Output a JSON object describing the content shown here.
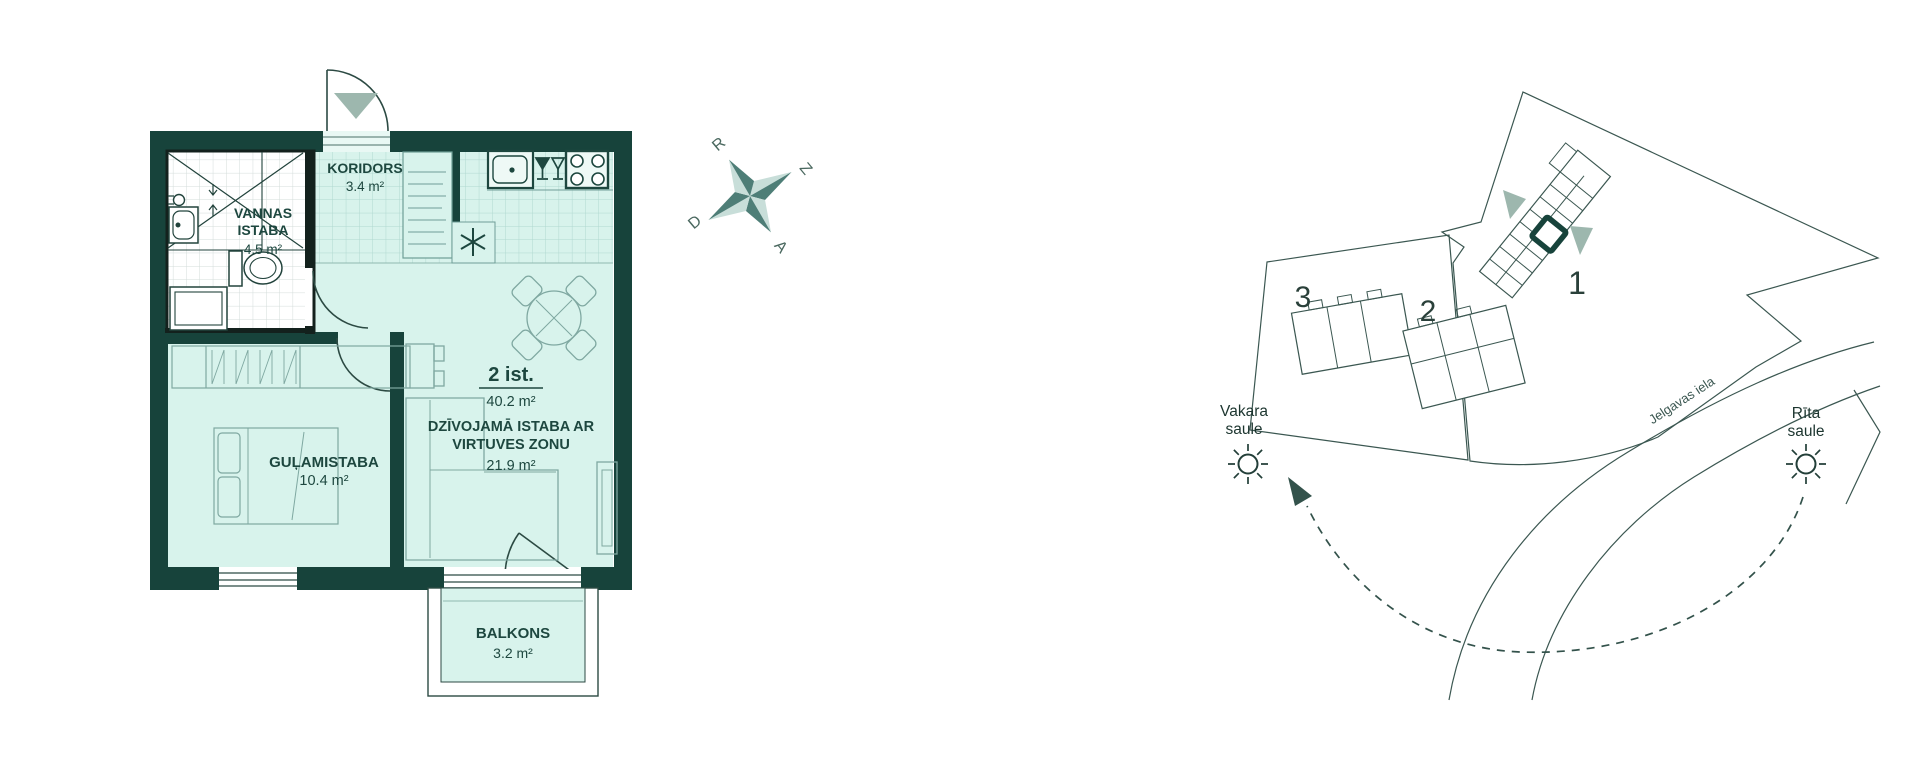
{
  "floor_plan": {
    "rooms": {
      "bathroom": {
        "name_line1": "VANNAS",
        "name_line2": "ISTABA",
        "area": "4.5 m²"
      },
      "corridor": {
        "name": "KORIDORS",
        "area": "3.4 m²"
      },
      "bedroom": {
        "name": "GUĻAMISTABA",
        "area": "10.4 m²"
      },
      "living": {
        "name_line1": "DZĪVOJAMĀ ISTABA AR",
        "name_line2": "VIRTUVES ZONU",
        "area": "21.9 m²"
      },
      "balcony": {
        "name": "BALKONS",
        "area": "3.2 m²"
      }
    },
    "summary": {
      "rooms_label": "2 ist.",
      "total_area": "40.2 m²"
    }
  },
  "compass": {
    "north": "Z",
    "south": "D",
    "east": "A",
    "west": "R"
  },
  "site_plan": {
    "buildings": [
      {
        "number": "1"
      },
      {
        "number": "2"
      },
      {
        "number": "3"
      }
    ],
    "street": "Jelgavas iela",
    "evening_sun": {
      "line1": "Vakara",
      "line2": "saule"
    },
    "morning_sun": {
      "line1": "Rīta",
      "line2": "saule"
    }
  },
  "colors": {
    "wall": "#17433b",
    "floor": "#d8f3ec",
    "tile_line": "#b0d8d0",
    "compass_dark": "#4e7e77",
    "compass_light": "#c8ded9",
    "entry_triangle": "#9db7ae",
    "site_line": "#3b5751",
    "unit_marker": "#17433b"
  }
}
